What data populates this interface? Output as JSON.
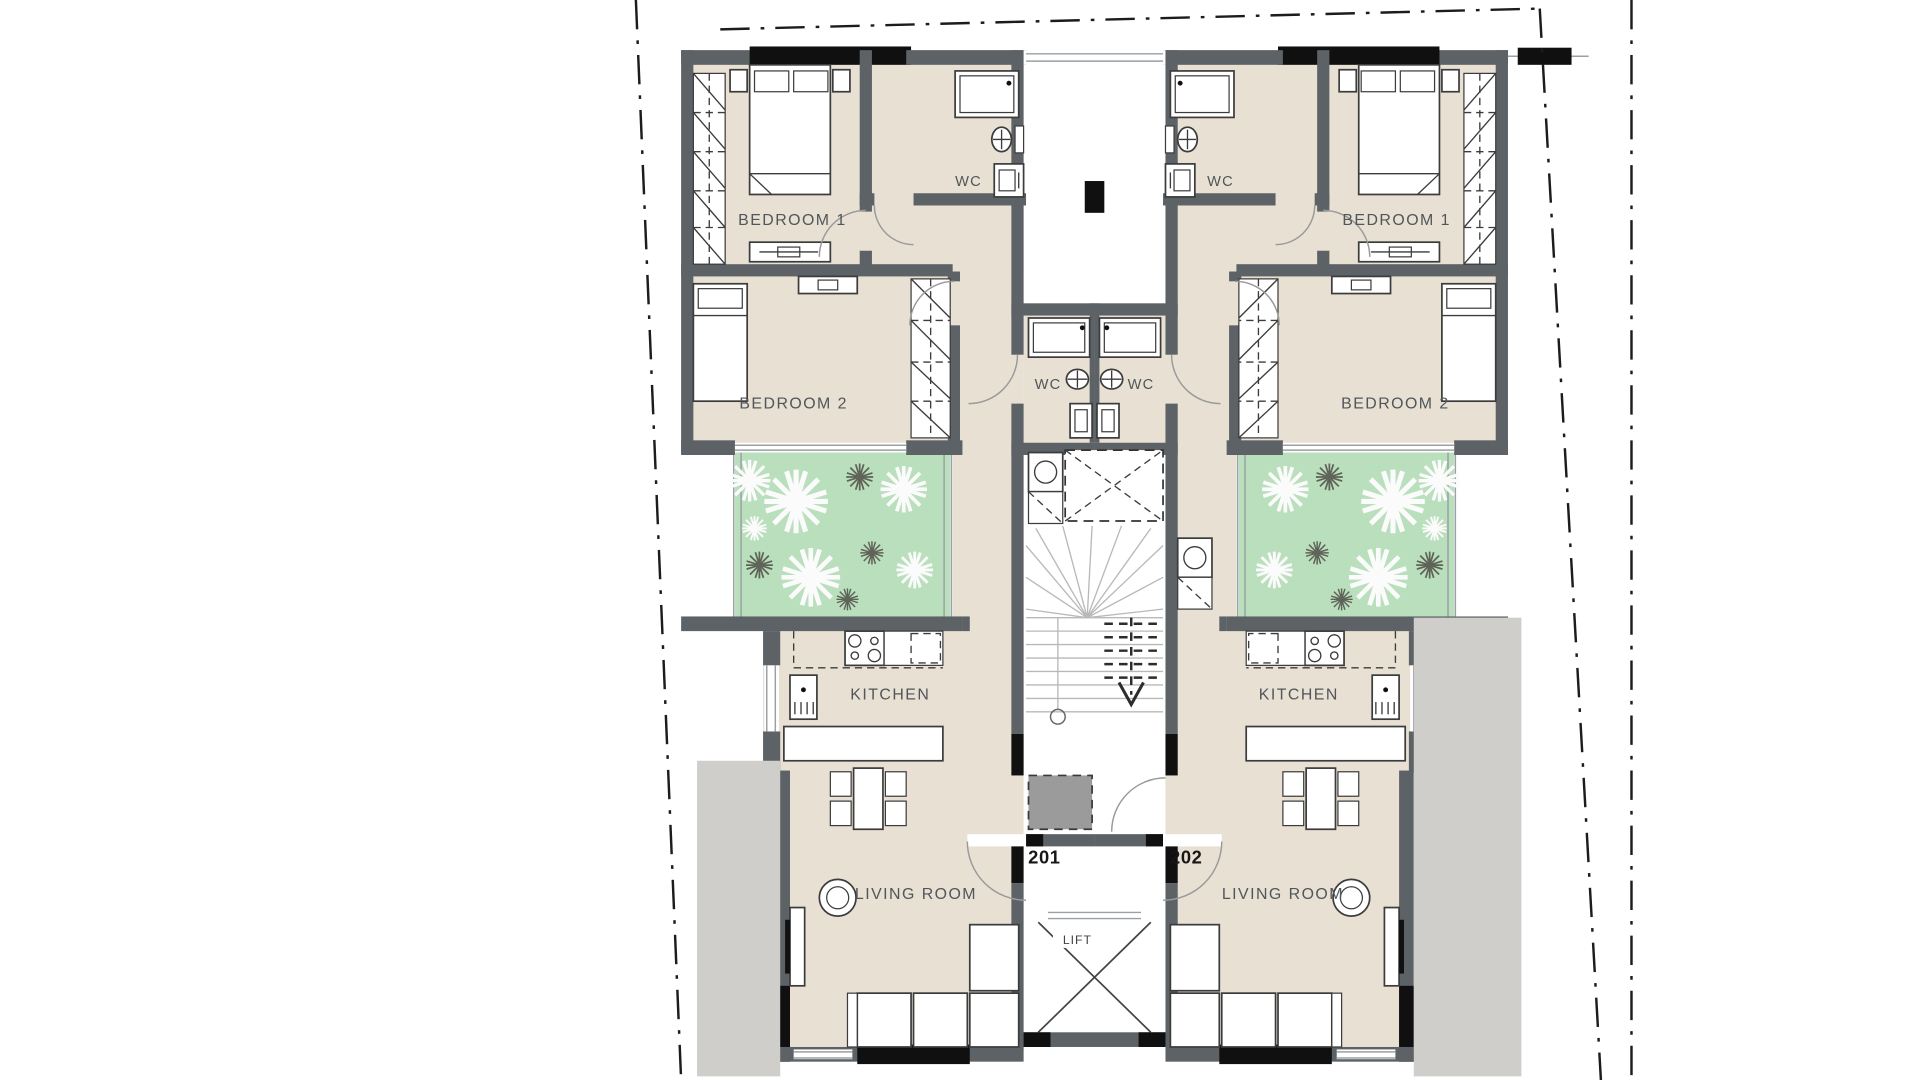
{
  "units": [
    {
      "number": "201",
      "rooms": {
        "bedroom1": "BEDROOM 1",
        "bedroom2": "BEDROOM 2",
        "kitchen": "KITCHEN",
        "living_room": "LIVING ROOM",
        "wc_upper": "WC",
        "wc_inner": "WC"
      }
    },
    {
      "number": "202",
      "rooms": {
        "bedroom1": "BEDROOM 1",
        "bedroom2": "BEDROOM 2",
        "kitchen": "KITCHEN",
        "living_room": "LIVING ROOM",
        "wc_upper": "WC",
        "wc_inner": "WC"
      }
    }
  ],
  "core": {
    "lift_label": "LIFT"
  },
  "colors": {
    "wall": "#5d6266",
    "pier": "#101010",
    "apartment_floor": "#e8e0d3",
    "garden": "#b9dfbc",
    "terrace": "#cfcecb",
    "entry_mat": "#9b9b9b",
    "label_text": "#51565b"
  }
}
